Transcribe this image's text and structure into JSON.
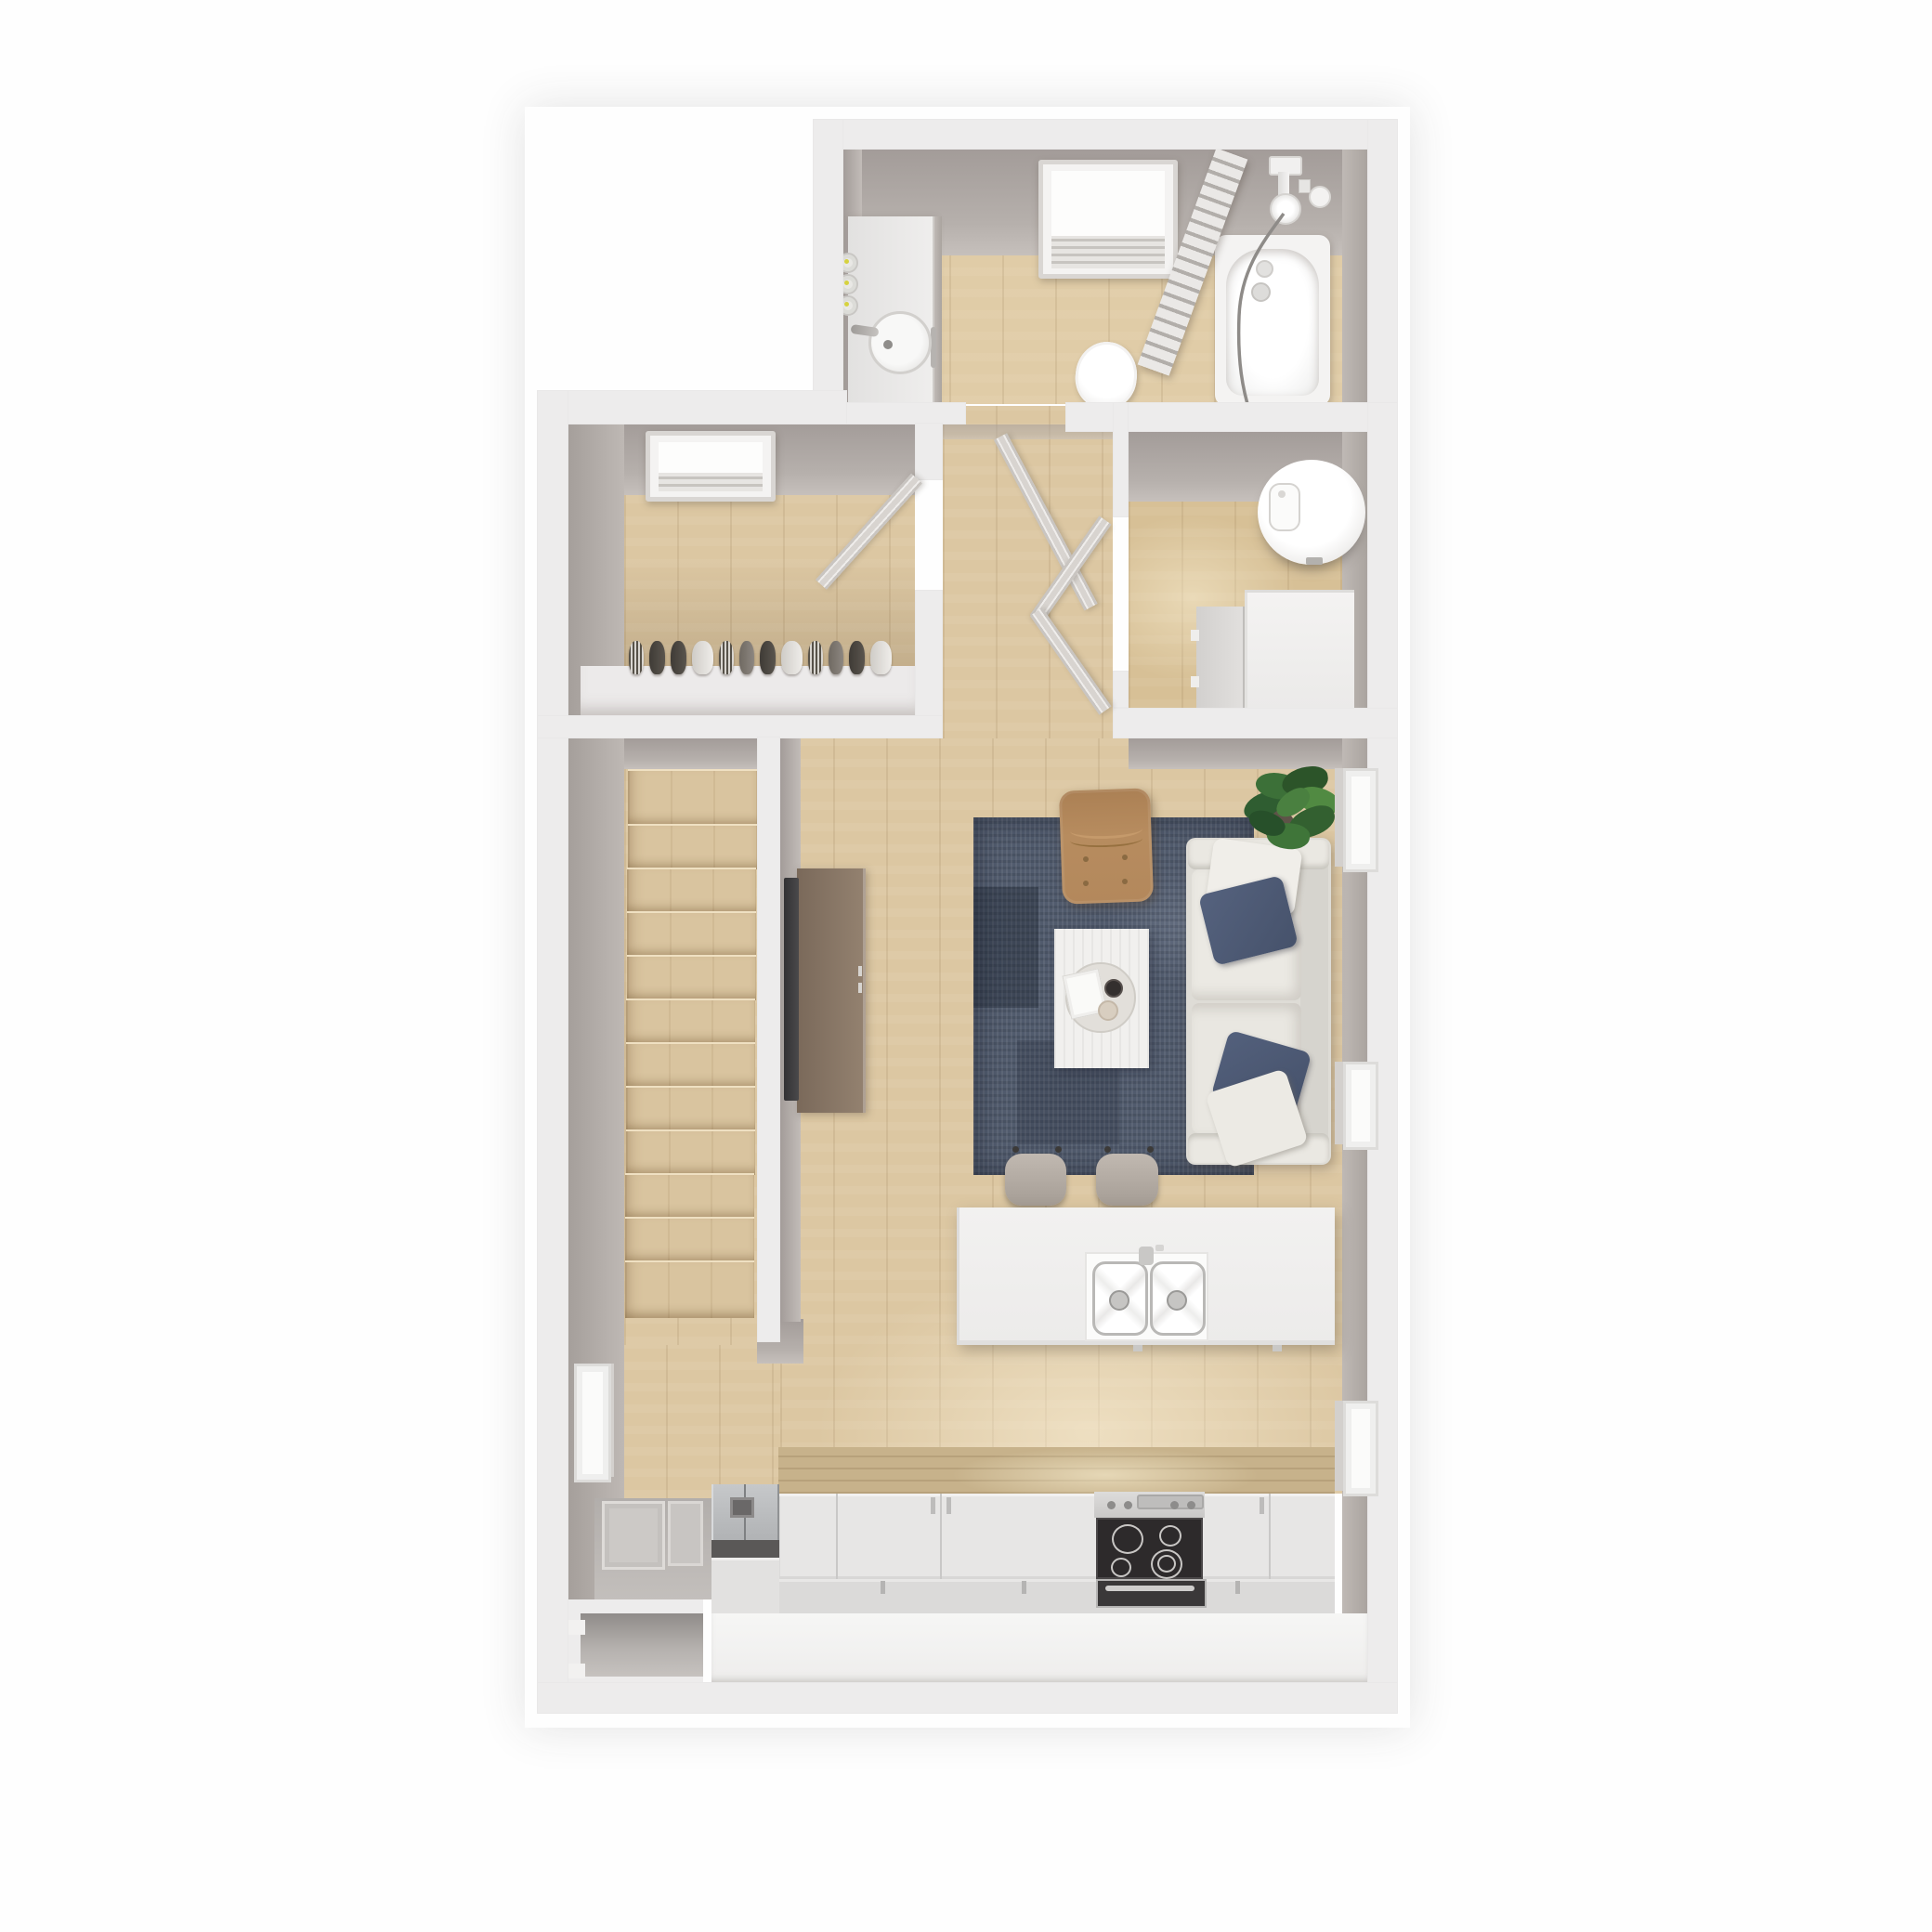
{
  "scene": {
    "type": "3d-floor-plan-render",
    "view": "top-down",
    "background": "#fefefe",
    "floors_shown": 1,
    "text_visible": "none"
  },
  "palette": {
    "wall-top": "#edecec",
    "face-dark": "#a39c99",
    "wood": "#dcc7a2",
    "wood-dark": "#c9b38d",
    "rug": "#515b6d",
    "sofa": "#e5e3dd",
    "pillow-navy": "#4d5a75",
    "armchair-tan": "#b3885c",
    "table-white": "#f1f0ee",
    "console-wood": "#86755f",
    "tv-dark": "#3c3b3d",
    "stainless": "#b9bbbd",
    "cooktop-black": "#2d2a2b",
    "stool": "#b3aaa2",
    "plant-green": "#3c7038",
    "heater-white": "#f6f5f4",
    "light-dot": "#d6d23e"
  },
  "rooms": [
    {
      "id": "bathroom",
      "label": "Bathroom",
      "features": [
        "skylight",
        "vanity-sink",
        "wall-lights",
        "toilet",
        "bathtub",
        "shower-screen",
        "shower-fixture"
      ]
    },
    {
      "id": "walk-in-closet",
      "label": "Walk-in Closet",
      "features": [
        "skylight",
        "clothes-rail",
        "shelf",
        "open-door"
      ]
    },
    {
      "id": "hallway",
      "label": "Hallway",
      "features": [
        "open-door-bathroom",
        "open-doors-utility"
      ]
    },
    {
      "id": "utility-room",
      "label": "Utility Room",
      "features": [
        "water-heater",
        "washing-machine",
        "cabinet"
      ]
    },
    {
      "id": "living-room",
      "label": "Living Room",
      "features": [
        "area-rug",
        "sofa",
        "navy-pillows",
        "armchair",
        "coffee-table",
        "round-tray",
        "tv",
        "tv-console",
        "potted-plant",
        "windows"
      ]
    },
    {
      "id": "kitchen",
      "label": "Kitchen",
      "features": [
        "island",
        "double-sink",
        "faucet",
        "bar-stools",
        "fridge",
        "cooktop",
        "oven",
        "cabinet-run",
        "window"
      ]
    },
    {
      "id": "staircase",
      "label": "Staircase",
      "features": [
        "wood-treads"
      ]
    },
    {
      "id": "entry",
      "label": "Entry",
      "features": [
        "front-door-open",
        "porch"
      ]
    }
  ],
  "closet": {
    "clothes_sequence": [
      "stripe",
      "dark",
      "dark",
      "white",
      "stripe",
      "gray",
      "dark",
      "white",
      "stripe",
      "gray",
      "dark",
      "white"
    ]
  },
  "staircase": {
    "steps_visible": 12
  },
  "counts": {
    "skylights": 2,
    "wall_windows": 4,
    "open_door_leaves": 4,
    "bar_stools": 2,
    "clothes_items": 12,
    "cooktop_burners": 4,
    "sink_basins": 2,
    "sofa_pillows": 4,
    "wall_lights": 3,
    "stair_treads": 12
  }
}
